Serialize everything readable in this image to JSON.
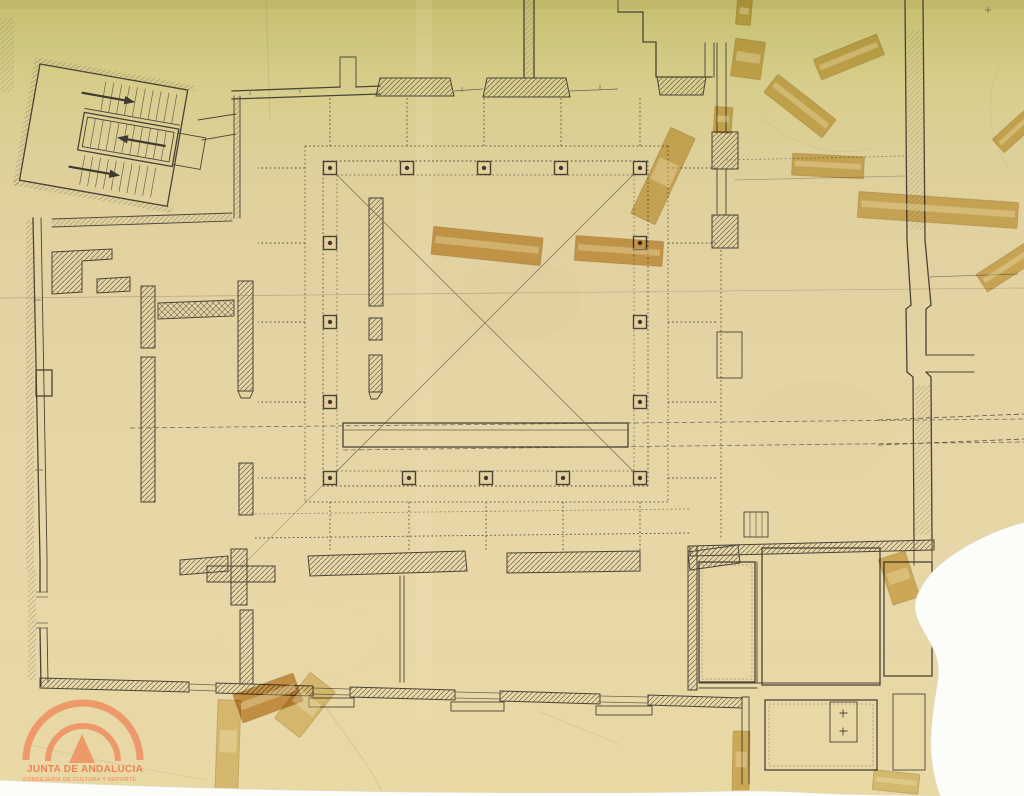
{
  "logo": {
    "org": "JUNTA DE ANDALUCIA",
    "dept": "CONSEJERIA DE CULTURA Y DEPORTE",
    "color": "#ee8a5c"
  },
  "palette": {
    "paper_top": "#c6bf70",
    "paper_mid": "#e4d2a2",
    "paper_bottom": "#e9d9a5",
    "ink": "#4a4437",
    "faint_ink": "#8a806a",
    "tape_mid": "#d8b866",
    "tape_dark": "#cfa049",
    "tape_dark2": "#c9913f",
    "tape_light": "#e3cf92",
    "tear_white": "#fcfcf8",
    "column_fill": "#e5d1a0"
  },
  "plan": {
    "column_count": 16,
    "stair_arrow_count": 3,
    "columns": [
      {
        "x": 330,
        "y": 168
      },
      {
        "x": 407,
        "y": 168
      },
      {
        "x": 484,
        "y": 168
      },
      {
        "x": 561,
        "y": 168
      },
      {
        "x": 640,
        "y": 168
      },
      {
        "x": 330,
        "y": 243
      },
      {
        "x": 640,
        "y": 243
      },
      {
        "x": 330,
        "y": 322
      },
      {
        "x": 640,
        "y": 322
      },
      {
        "x": 330,
        "y": 402
      },
      {
        "x": 640,
        "y": 402
      },
      {
        "x": 330,
        "y": 478
      },
      {
        "x": 409,
        "y": 478
      },
      {
        "x": 486,
        "y": 478
      },
      {
        "x": 563,
        "y": 478
      },
      {
        "x": 640,
        "y": 478
      }
    ],
    "tapes": [
      {
        "cx": 487,
        "cy": 246,
        "w": 110,
        "h": 28,
        "rot": 6,
        "tone": "tape_dark"
      },
      {
        "cx": 619,
        "cy": 251,
        "w": 88,
        "h": 25,
        "rot": 4,
        "tone": "tape_dark"
      },
      {
        "cx": 663,
        "cy": 176,
        "w": 27,
        "h": 95,
        "rot": 25,
        "tone": "tape_mid"
      },
      {
        "cx": 800,
        "cy": 106,
        "w": 74,
        "h": 23,
        "rot": 38,
        "tone": "tape_mid"
      },
      {
        "cx": 849,
        "cy": 57,
        "w": 68,
        "h": 22,
        "rot": -22,
        "tone": "tape_mid"
      },
      {
        "cx": 828,
        "cy": 166,
        "w": 72,
        "h": 22,
        "rot": 3,
        "tone": "tape_mid"
      },
      {
        "cx": 938,
        "cy": 210,
        "w": 160,
        "h": 26,
        "rot": 4,
        "tone": "tape_mid"
      },
      {
        "cx": 1007,
        "cy": 267,
        "w": 60,
        "h": 21,
        "rot": -33,
        "tone": "tape_mid"
      },
      {
        "cx": 1016,
        "cy": 130,
        "w": 48,
        "h": 18,
        "rot": -42,
        "tone": "tape_mid"
      },
      {
        "cx": 748,
        "cy": 59,
        "w": 30,
        "h": 38,
        "rot": 8,
        "tone": "tape_mid"
      },
      {
        "cx": 723,
        "cy": 120,
        "w": 18,
        "h": 26,
        "rot": 4,
        "tone": "tape_mid"
      },
      {
        "cx": 744,
        "cy": 12,
        "w": 15,
        "h": 26,
        "rot": 5,
        "tone": "tape_mid"
      },
      {
        "cx": 268,
        "cy": 698,
        "w": 64,
        "h": 30,
        "rot": -20,
        "tone": "tape_dark2"
      },
      {
        "cx": 305,
        "cy": 705,
        "w": 32,
        "h": 58,
        "rot": 38,
        "tone": "tape_light"
      },
      {
        "cx": 228,
        "cy": 745,
        "w": 23,
        "h": 90,
        "rot": 2,
        "tone": "tape_light"
      },
      {
        "cx": 741,
        "cy": 762,
        "w": 17,
        "h": 62,
        "rot": 1,
        "tone": "tape_mid"
      },
      {
        "cx": 899,
        "cy": 578,
        "w": 28,
        "h": 48,
        "rot": -18,
        "tone": "tape_mid"
      },
      {
        "cx": 896,
        "cy": 782,
        "w": 46,
        "h": 20,
        "rot": 6,
        "tone": "tape_light"
      }
    ]
  }
}
